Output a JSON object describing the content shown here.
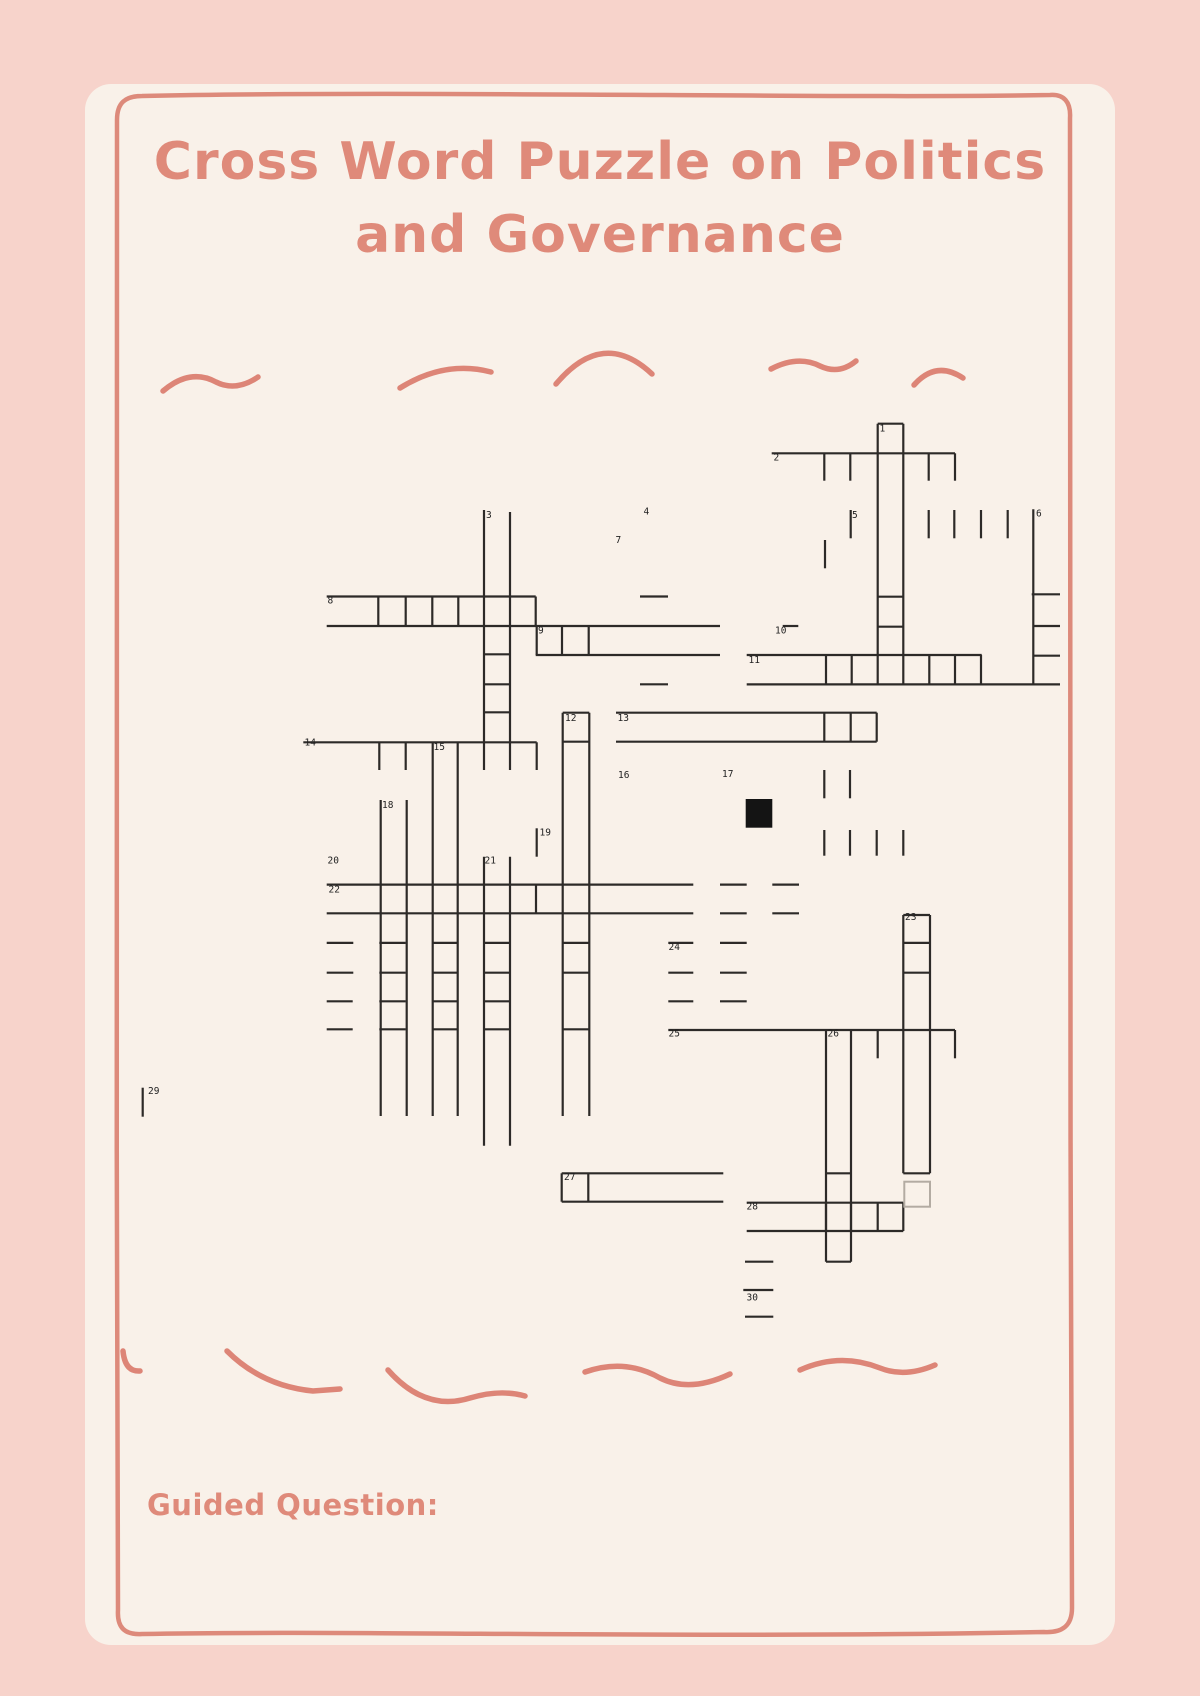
{
  "page": {
    "background": "#f7d3cb",
    "card_background": "#f9f1e9",
    "accent_color": "#df8a7a",
    "grid_line_color": "#2d2a28",
    "black_cell_color": "#141414",
    "gray_cell_border_color": "#b3aba2",
    "number_color": "#222222"
  },
  "title": {
    "line1": "Cross Word Puzzle on Politics",
    "line2": "and Governance"
  },
  "footer": {
    "guided_question_label": "Guided Question:"
  },
  "puzzle": {
    "numbers": [
      [
        1,
        879.5,
        425
      ],
      [
        2,
        773.5,
        454
      ],
      [
        3,
        486,
        511.5
      ],
      [
        4,
        643.5,
        508
      ],
      [
        5,
        852,
        511.5
      ],
      [
        6,
        1036,
        510
      ],
      [
        7,
        615.5,
        536.5
      ],
      [
        8,
        327.5,
        597
      ],
      [
        9,
        538,
        627
      ],
      [
        10,
        775,
        627
      ],
      [
        11,
        748.5,
        656.5
      ],
      [
        12,
        565,
        714.5
      ],
      [
        13,
        617.5,
        714.5
      ],
      [
        14,
        304.5,
        739
      ],
      [
        15,
        433.5,
        743.5
      ],
      [
        16,
        618,
        771.5
      ],
      [
        17,
        722,
        770.5
      ],
      [
        18,
        382,
        801.5
      ],
      [
        19,
        539.5,
        829
      ],
      [
        20,
        327.5,
        857
      ],
      [
        21,
        484.5,
        857
      ],
      [
        22,
        328.5,
        886
      ],
      [
        23,
        905,
        913.5
      ],
      [
        24,
        668.5,
        943.5
      ],
      [
        25,
        668.5,
        1030
      ],
      [
        26,
        827.5,
        1030
      ],
      [
        27,
        564,
        1173.5
      ],
      [
        28,
        746.5,
        1203
      ],
      [
        29,
        148,
        1087.5
      ],
      [
        30,
        746.5,
        1294
      ]
    ],
    "h_segments": [
      [
        877.7,
        903.3,
        423.7
      ],
      [
        771.7,
        955,
        453.3
      ],
      [
        326.7,
        535.7,
        596.5
      ],
      [
        640,
        668,
        596.5
      ],
      [
        877.7,
        903.3,
        596.7
      ],
      [
        1031.7,
        1060,
        594.3
      ],
      [
        326.7,
        720,
        626
      ],
      [
        782.7,
        798.3,
        626
      ],
      [
        877.7,
        903.3,
        626.7
      ],
      [
        1033.3,
        1060,
        626
      ],
      [
        535.7,
        720,
        655
      ],
      [
        746.7,
        981.7,
        655
      ],
      [
        1033.3,
        1060,
        655.7
      ],
      [
        484,
        510,
        654.3
      ],
      [
        640,
        668,
        684.3
      ],
      [
        746.7,
        1060,
        684.4
      ],
      [
        484,
        510,
        684.3
      ],
      [
        484,
        510,
        712.3
      ],
      [
        562.7,
        589.3,
        712.7
      ],
      [
        616,
        876.7,
        712.7
      ],
      [
        562.7,
        589.3,
        741.7
      ],
      [
        616,
        876.7,
        741.7
      ],
      [
        303.3,
        536.7,
        742.3
      ],
      [
        326.7,
        693.3,
        884.6
      ],
      [
        720,
        746.7,
        884.6
      ],
      [
        772.3,
        799,
        884.6
      ],
      [
        326.7,
        693.3,
        913.3
      ],
      [
        720,
        746.7,
        913.3
      ],
      [
        772.3,
        799,
        913.3
      ],
      [
        903.3,
        930,
        915
      ],
      [
        326.7,
        353.3,
        942.9
      ],
      [
        379.3,
        405.7,
        942.9
      ],
      [
        432.7,
        458.3,
        942.9
      ],
      [
        484,
        510,
        942.9
      ],
      [
        562.7,
        589.3,
        942.9
      ],
      [
        668.3,
        693.3,
        942.9
      ],
      [
        720,
        746.7,
        942.9
      ],
      [
        903.3,
        930,
        942.9
      ],
      [
        326.7,
        353.3,
        972.7
      ],
      [
        379.3,
        405.7,
        972.7
      ],
      [
        432.7,
        458.3,
        972.7
      ],
      [
        484,
        510,
        972.7
      ],
      [
        562.7,
        589.3,
        972.7
      ],
      [
        668.3,
        693.3,
        972.7
      ],
      [
        720,
        746.7,
        972.7
      ],
      [
        903.3,
        930,
        972.7
      ],
      [
        326.7,
        352.7,
        1001.3
      ],
      [
        379.3,
        405.7,
        1001.3
      ],
      [
        432.7,
        458.3,
        1001.3
      ],
      [
        484,
        510,
        1001.3
      ],
      [
        668.3,
        693.3,
        1001.3
      ],
      [
        720,
        746.7,
        1001.3
      ],
      [
        326.7,
        352.7,
        1029.3
      ],
      [
        379.3,
        405.7,
        1029.3
      ],
      [
        432.7,
        458.3,
        1029.3
      ],
      [
        484,
        510,
        1029.3
      ],
      [
        562.7,
        589.3,
        1029.3
      ],
      [
        668.3,
        955,
        1030
      ],
      [
        826,
        851,
        1173.3
      ],
      [
        561.7,
        723.3,
        1173.3
      ],
      [
        903.3,
        930,
        1173.3
      ],
      [
        561.7,
        723.3,
        1201.7
      ],
      [
        746.7,
        903.3,
        1202.7
      ],
      [
        746.7,
        903.3,
        1231
      ],
      [
        826,
        851,
        1261.7
      ],
      [
        745,
        773.3,
        1261.7
      ],
      [
        743.3,
        773.3,
        1290
      ],
      [
        745,
        773.3,
        1316.7
      ]
    ],
    "v_segments": [
      [
        877.7,
        423.7,
        684.3
      ],
      [
        903.3,
        423.7,
        684.3
      ],
      [
        824.3,
        453.3,
        480.7
      ],
      [
        850.3,
        453.3,
        480.7
      ],
      [
        928.7,
        453.3,
        480.7
      ],
      [
        955,
        453.3,
        480.7
      ],
      [
        850.7,
        510,
        538.3
      ],
      [
        928.7,
        510,
        538.3
      ],
      [
        954.3,
        510,
        538.3
      ],
      [
        981,
        510,
        538.3
      ],
      [
        1007.7,
        510,
        538.3
      ],
      [
        1033.3,
        509.3,
        685
      ],
      [
        484,
        510,
        770
      ],
      [
        510,
        512,
        770
      ],
      [
        825,
        540,
        568.3
      ],
      [
        378.3,
        596.5,
        626
      ],
      [
        405.7,
        596.5,
        626
      ],
      [
        432.3,
        596.5,
        626
      ],
      [
        458.3,
        596.5,
        626
      ],
      [
        535.7,
        596.5,
        626
      ],
      [
        536.7,
        626,
        655
      ],
      [
        562,
        626,
        655
      ],
      [
        588.7,
        626,
        655
      ],
      [
        826,
        655,
        684.3
      ],
      [
        851.7,
        655,
        684.3
      ],
      [
        929.3,
        655,
        684.3
      ],
      [
        955,
        655,
        684.3
      ],
      [
        981,
        655,
        684.3
      ],
      [
        562.7,
        712.7,
        1116
      ],
      [
        589.3,
        712.7,
        1116
      ],
      [
        824.3,
        712.7,
        741.7
      ],
      [
        850.7,
        712.7,
        741.7
      ],
      [
        876.7,
        712.7,
        741.7
      ],
      [
        379.3,
        742.3,
        770
      ],
      [
        405.7,
        742.3,
        770
      ],
      [
        536.7,
        742.3,
        770
      ],
      [
        432.7,
        742.3,
        1116
      ],
      [
        457.7,
        742.3,
        1116
      ],
      [
        824.3,
        770,
        798.3
      ],
      [
        850,
        770,
        798.3
      ],
      [
        380.7,
        800,
        1116
      ],
      [
        406.7,
        800,
        1116
      ],
      [
        536.7,
        828.3,
        856.7
      ],
      [
        824.3,
        830,
        855.7
      ],
      [
        850,
        830,
        855.7
      ],
      [
        876.7,
        830,
        855.7
      ],
      [
        903.3,
        830,
        855.7
      ],
      [
        484,
        856.7,
        1145.7
      ],
      [
        510,
        856.7,
        1145.7
      ],
      [
        536,
        884.6,
        913.3
      ],
      [
        903.3,
        915,
        1173.3
      ],
      [
        930,
        915,
        1173.3
      ],
      [
        877.7,
        1030,
        1058.3
      ],
      [
        955,
        1030,
        1058.3
      ],
      [
        826,
        1030,
        1261.7
      ],
      [
        851,
        1030,
        1261.7
      ],
      [
        561.7,
        1173.3,
        1201.7
      ],
      [
        588.3,
        1173.3,
        1201.7
      ],
      [
        826,
        1202.7,
        1231
      ],
      [
        851,
        1202.7,
        1231
      ],
      [
        877.7,
        1202.7,
        1231
      ],
      [
        903.3,
        1202.7,
        1231
      ],
      [
        142.7,
        1087.7,
        1116.7
      ]
    ],
    "black_cell": {
      "x": 745.7,
      "y": 799,
      "w": 26.6,
      "h": 28.7
    },
    "gray_cell": {
      "x": 904.3,
      "y": 1181.7,
      "w": 25.7,
      "h": 25
    }
  }
}
